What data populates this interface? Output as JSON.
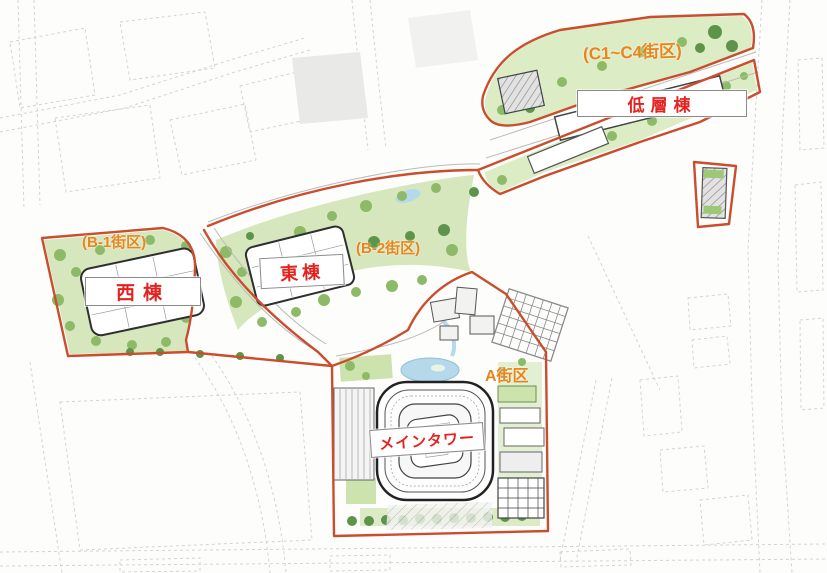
{
  "page": {
    "type": "redevelopment-site-plan-map"
  },
  "map": {
    "district_labels": {
      "c1_c4": "(C1~C4街区)",
      "b1": "(B-1街区)",
      "b2": "(B-2街区)",
      "a": "A街区"
    },
    "building_labels": {
      "low_rise": "低層棟",
      "west": "西棟",
      "east": "東棟",
      "main_tower": "メインタワー"
    },
    "colors": {
      "site_boundary": "#c84e2e",
      "district_label_text": "#e8861c",
      "building_label_text": "#e42320",
      "vegetation": "#cde3ae",
      "vegetation_dark": "#8cba67",
      "tree_dark": "#5d944a",
      "water": "#b5d9ea",
      "building_outline": "#2f2f2f",
      "background_streets": "#c9cdd2"
    }
  }
}
